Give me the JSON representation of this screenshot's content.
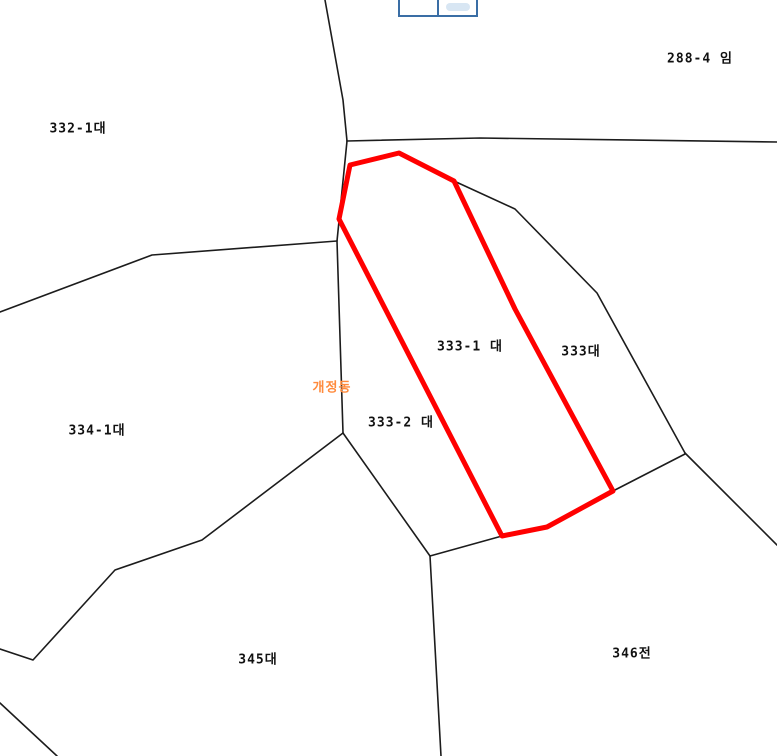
{
  "map": {
    "background_color": "#ffffff",
    "boundary_color": "#1c1c1c",
    "highlight_color": "#ff0000",
    "district_label_color": "#ff8a3c",
    "toolbar_border_color": "#3a6ea5"
  },
  "geometry": {
    "red_parcel_points": "350,165 399,153 454,181 515,309 613,491 547,527 502,536 339,219",
    "black_lines": [
      "325,0 343,100 347,141",
      "347,141 480,138 777,142",
      "347,141 337,241 343,433",
      "0,312 152,255 337,241",
      "343,433 202,540 115,570 33,660 0,649",
      "343,433 430,556 441,756",
      "502,536 430,556",
      "613,491 685,454",
      "454,181 515,209 597,293 685,453",
      "685,453 777,545",
      "0,703 57,756"
    ]
  },
  "labels": [
    {
      "text": "288-4 임",
      "type": "parcel"
    },
    {
      "text": "332-1대",
      "type": "parcel"
    },
    {
      "text": "333-1 대",
      "type": "parcel-highlighted"
    },
    {
      "text": "333대",
      "type": "parcel"
    },
    {
      "text": "333-2 대",
      "type": "parcel"
    },
    {
      "text": "334-1대",
      "type": "parcel"
    },
    {
      "text": "345대",
      "type": "parcel"
    },
    {
      "text": "346전",
      "type": "parcel"
    },
    {
      "text": "개정동",
      "type": "district"
    }
  ]
}
